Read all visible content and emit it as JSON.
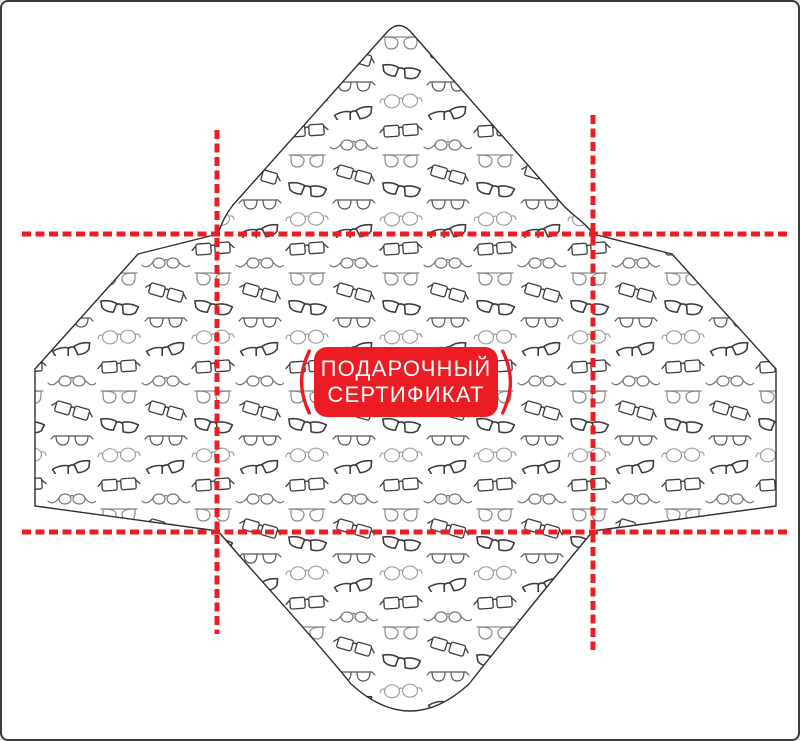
{
  "badge": {
    "line1": "ПОДАРОЧНЫЙ",
    "line2": "СЕРТИФИКАТ"
  },
  "template": {
    "kind": "envelope die-cut template",
    "fold_marks": "red dashed fold/cut guide lines",
    "pattern_motif": "assorted eyeglasses outline drawings in a staggered grid"
  },
  "colors": {
    "accent_red": "#ec1c24",
    "outline_dark": "#2f2f2f",
    "frame_border": "#3a3a3a",
    "background": "#ffffff",
    "pattern_gray_dark": "#3d3d3d",
    "pattern_gray_mid": "#777777",
    "pattern_gray_light": "#9e9e9e"
  }
}
